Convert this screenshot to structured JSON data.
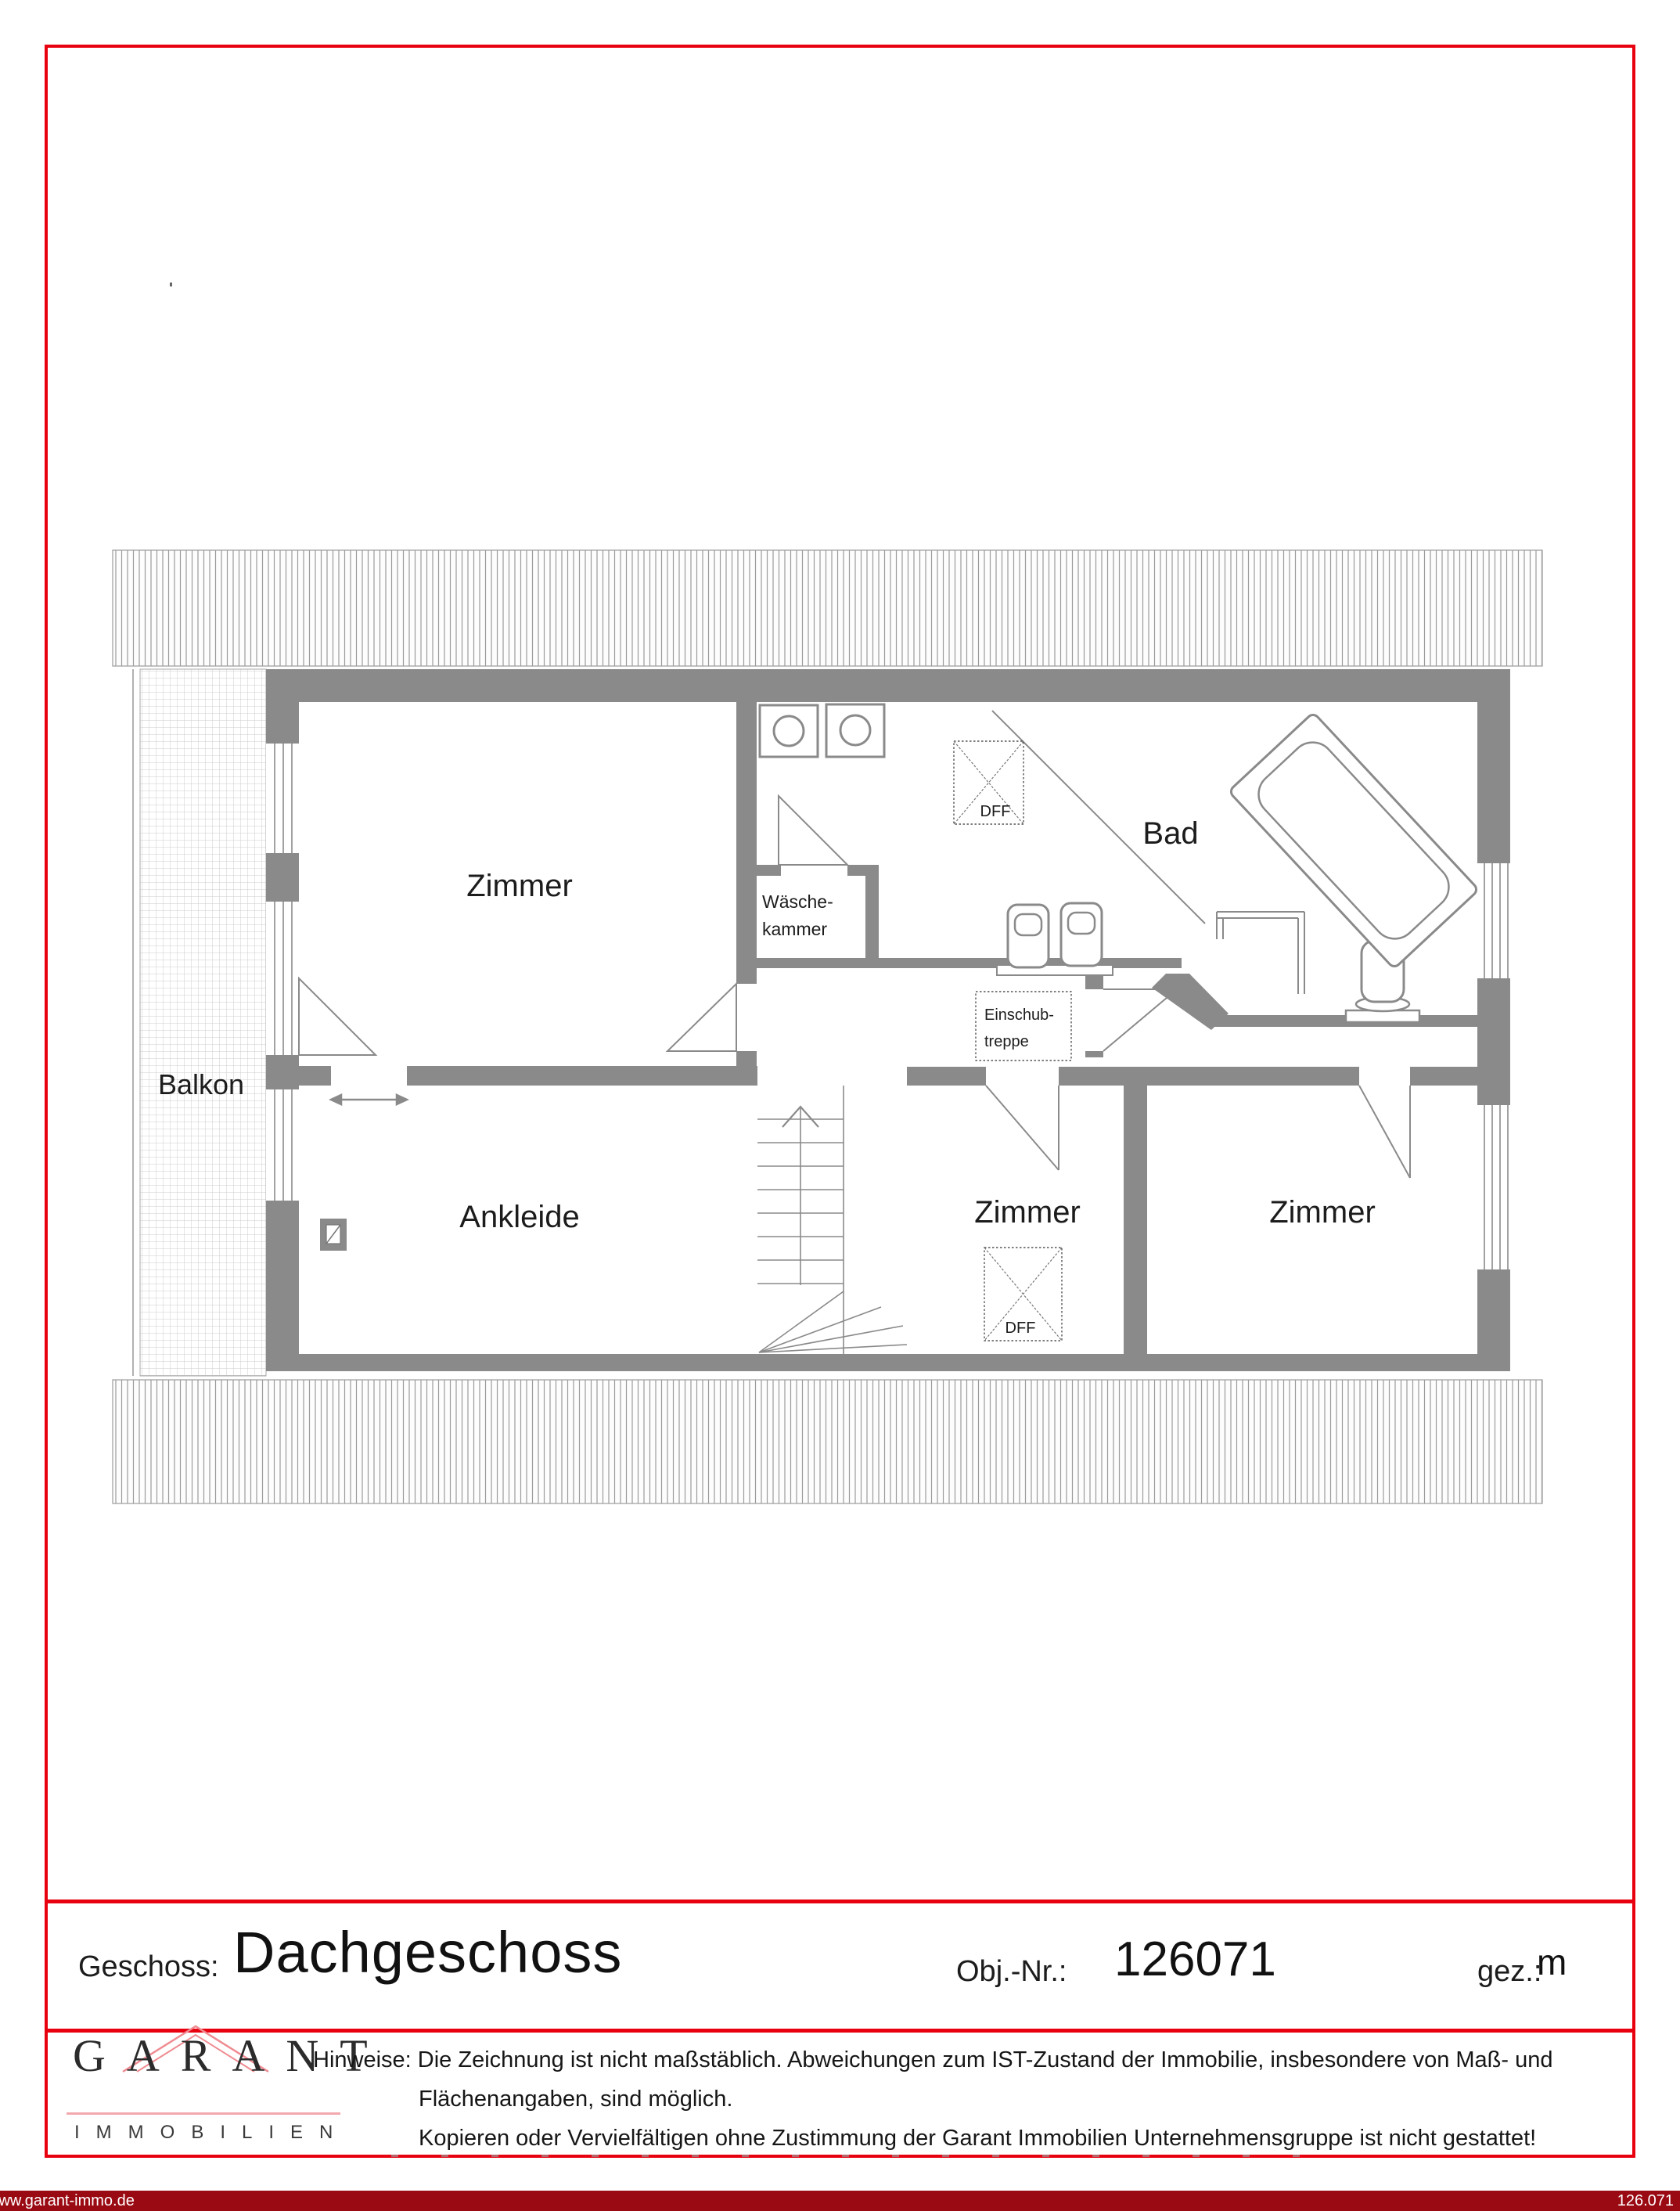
{
  "colors": {
    "frame_red": "#e8000f",
    "footer_maroon": "#9a0a12",
    "wall_gray": "#8a8a8a",
    "logo_roof_pink": "#ef8b91"
  },
  "plan": {
    "labels": {
      "zimmer_tl": "Zimmer",
      "bad": "Bad",
      "waesche1": "Wäsche-",
      "waesche2": "kammer",
      "einschub1": "Einschub-",
      "einschub2": "treppe",
      "balkon": "Balkon",
      "ankleide": "Ankleide",
      "zimmer_mid": "Zimmer",
      "zimmer_right": "Zimmer",
      "dff_bad": "DFF",
      "dff_mid": "DFF"
    }
  },
  "title_block": {
    "geschoss_label": "Geschoss:",
    "geschoss_value": "Dachgeschoss",
    "obj_label": "Obj.-Nr.:",
    "obj_value": "126071",
    "gez_label": "gez.:",
    "gez_value": "m"
  },
  "logo": {
    "name": "GARANT",
    "subtitle": "IMMOBILIEN"
  },
  "hinweise": {
    "label": "Hinweise:",
    "line1": "Die Zeichnung ist nicht maßstäblich. Abweichungen zum IST-Zustand der Immobilie, insbesondere von Maß- und",
    "line2": "Flächenangaben, sind möglich.",
    "line3": "Kopieren oder Vervielfältigen ohne Zustimmung der Garant Immobilien Unternehmensgruppe ist nicht gestattet!"
  },
  "footer": {
    "left": "www.garant-immo.de",
    "right": "126.071"
  }
}
